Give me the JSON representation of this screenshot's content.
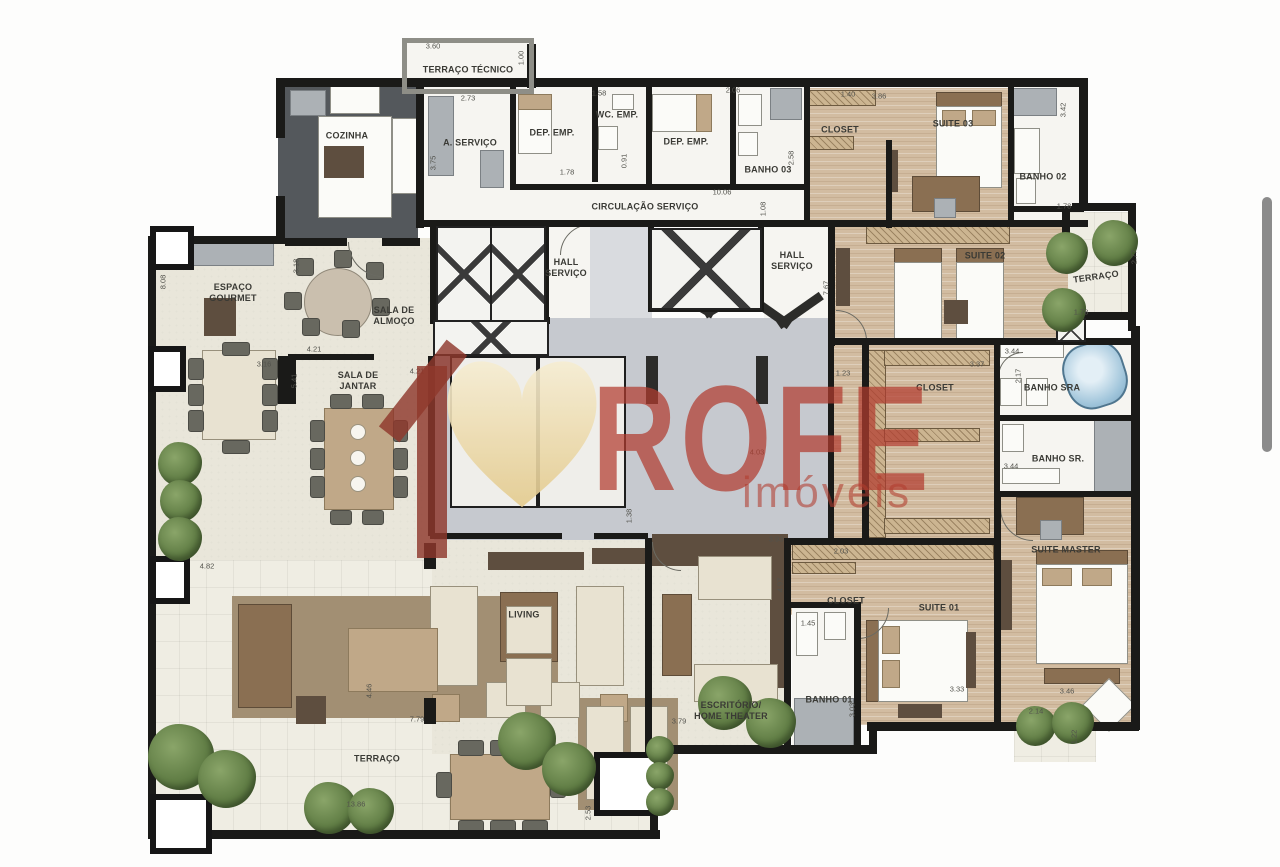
{
  "watermark": {
    "brand": "ROFE",
    "subtitle": "imóveis",
    "brand_color": "#b13c2f",
    "logo": "house-heart-icon",
    "logo_heart_color": "#eeda9f",
    "logo_house_color": "#8f382c"
  },
  "plan": {
    "rooms": [
      {
        "label": "TERRAÇO TÉCNICO"
      },
      {
        "label": "COZINHA"
      },
      {
        "label": "A. SERVIÇO"
      },
      {
        "label": "DEP. EMP."
      },
      {
        "label": "WC. EMP."
      },
      {
        "label": "DEP. EMP."
      },
      {
        "label": "BANHO 03"
      },
      {
        "label": "CLOSET"
      },
      {
        "label": "SUITE 03"
      },
      {
        "label": "BANHO 02"
      },
      {
        "label": "CIRCULAÇÃO SERVIÇO"
      },
      {
        "label": "HALL\nSERVIÇO"
      },
      {
        "label": "HALL\nSERVIÇO"
      },
      {
        "label": "TERRAÇO"
      },
      {
        "label": "SUITE 02"
      },
      {
        "label": "ESPAÇO\nGOURMET"
      },
      {
        "label": "SALA DE\nALMOÇO"
      },
      {
        "label": "SALA DE\nJANTAR"
      },
      {
        "label": "CLOSET"
      },
      {
        "label": "BANHO SRA"
      },
      {
        "label": "BANHO SR."
      },
      {
        "label": "SUITE MASTER"
      },
      {
        "label": "CLOSET"
      },
      {
        "label": "SUITE 01"
      },
      {
        "label": "BANHO 01"
      },
      {
        "label": "ESCRITÓRIO/\nHOME THEATER"
      },
      {
        "label": "LIVING"
      },
      {
        "label": "TERRAÇO"
      }
    ],
    "dims": [
      {
        "v": "3.60"
      },
      {
        "v": "1.00"
      },
      {
        "v": "2.73"
      },
      {
        "v": "3.75"
      },
      {
        "v": "1.78"
      },
      {
        "v": "1.58"
      },
      {
        "v": "0.91"
      },
      {
        "v": "2.06"
      },
      {
        "v": "2.58"
      },
      {
        "v": "10.06"
      },
      {
        "v": "1.08"
      },
      {
        "v": "1.40"
      },
      {
        "v": "3.86"
      },
      {
        "v": "3.42"
      },
      {
        "v": "1.78"
      },
      {
        "v": "7.67"
      },
      {
        "v": "1.23"
      },
      {
        "v": "2.77"
      },
      {
        "v": "1.78"
      },
      {
        "v": "3.44"
      },
      {
        "v": "2.17"
      },
      {
        "v": "3.37"
      },
      {
        "v": "3.44"
      },
      {
        "v": "8.08"
      },
      {
        "v": "3.18"
      },
      {
        "v": "3.16"
      },
      {
        "v": "5.41"
      },
      {
        "v": "4.21"
      },
      {
        "v": "4.21"
      },
      {
        "v": "4.82"
      },
      {
        "v": "3.93"
      },
      {
        "v": "2.03"
      },
      {
        "v": "4.97"
      },
      {
        "v": "4.03"
      },
      {
        "v": "1.38"
      },
      {
        "v": "3.79"
      },
      {
        "v": "2.53"
      },
      {
        "v": "13.86"
      },
      {
        "v": "7.79"
      },
      {
        "v": "4.46"
      },
      {
        "v": "3.33"
      },
      {
        "v": "3.46"
      },
      {
        "v": "2.14"
      },
      {
        "v": "1.22"
      },
      {
        "v": "3.03"
      },
      {
        "v": "1.45"
      }
    ]
  }
}
